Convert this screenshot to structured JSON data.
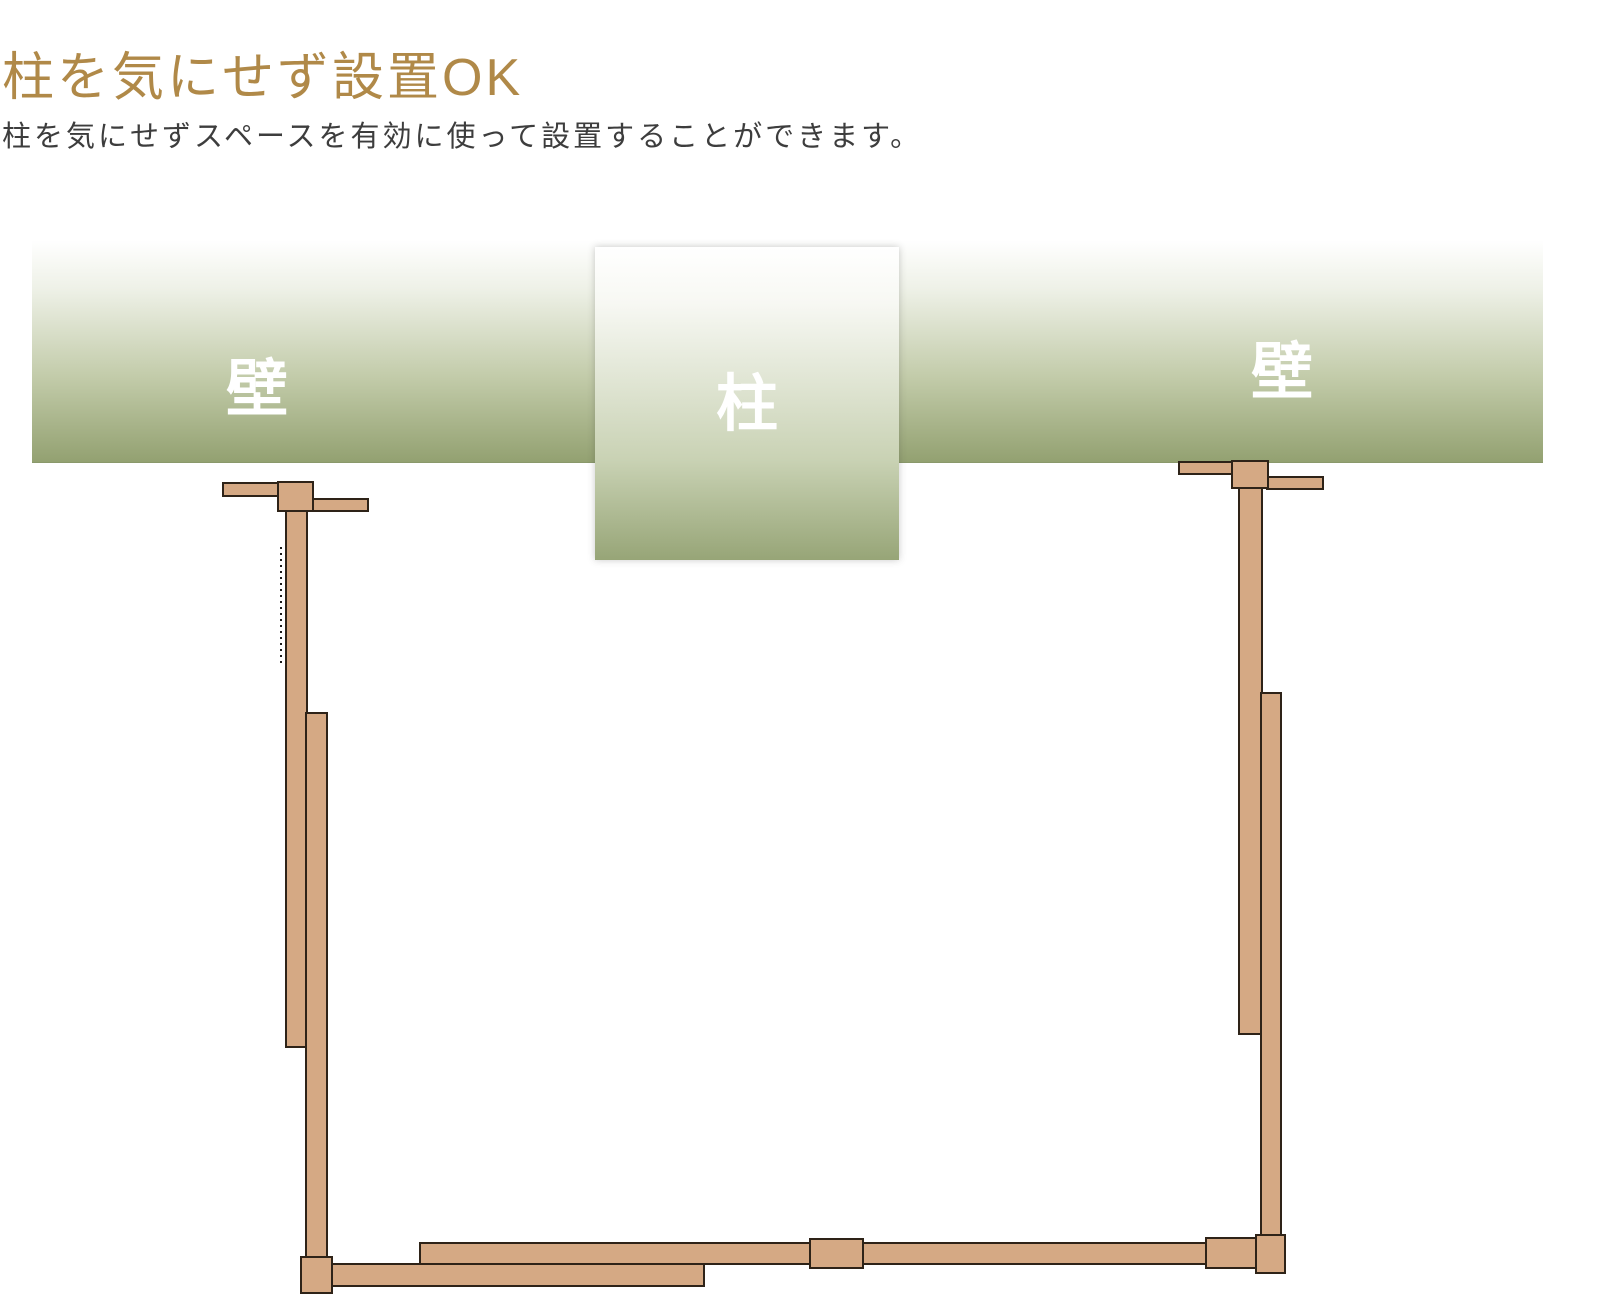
{
  "page": {
    "title": "柱を気にせず設置OK",
    "subtitle": "柱を気にせずスペースを有効に使って設置することができます。"
  },
  "diagram": {
    "labels": {
      "wall_left": "壁",
      "pillar": "柱",
      "wall_right": "壁"
    },
    "colors": {
      "title_text": "#b08948",
      "body_text": "#3d3d3d",
      "wall_green_deep": "#93a171",
      "pillar_green_deep": "#97a577",
      "label_text": "#ffffff",
      "wood_fill": "#d5a984",
      "wood_stroke": "#2e2318"
    }
  }
}
